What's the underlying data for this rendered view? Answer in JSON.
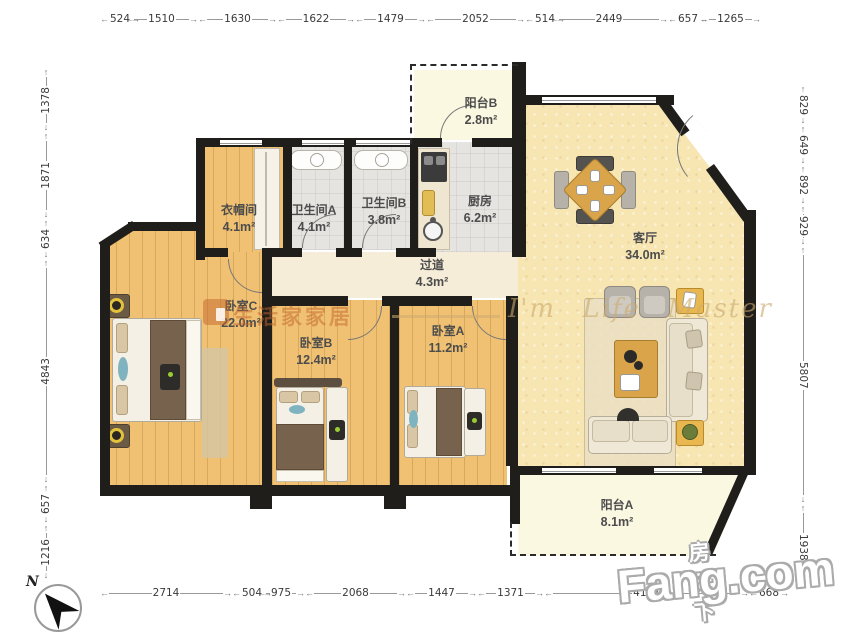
{
  "dims": {
    "top": [
      "524",
      "1510",
      "1630",
      "1622",
      "1479",
      "2052",
      "514",
      "2449",
      "657",
      "1265"
    ],
    "bottom": [
      "2714",
      "504",
      "975",
      "2068",
      "1447",
      "1371",
      "4197",
      "668"
    ],
    "left": [
      "1378",
      "1871",
      "634",
      "4843",
      "657",
      "1216"
    ],
    "right": [
      "829",
      "649",
      "892",
      "929",
      "5807",
      "1938"
    ]
  },
  "rooms": {
    "balcony_b": {
      "name": "阳台B",
      "area": "2.8m²"
    },
    "cloakroom": {
      "name": "衣帽间",
      "area": "4.1m²"
    },
    "bathroom_a": {
      "name": "卫生间A",
      "area": "4.1m²"
    },
    "bathroom_b": {
      "name": "卫生间B",
      "area": "3.8m²"
    },
    "kitchen": {
      "name": "厨房",
      "area": "6.2m²"
    },
    "living_room": {
      "name": "客厅",
      "area": "34.0m²"
    },
    "bedroom_c": {
      "name": "卧室C",
      "area": "22.0m²"
    },
    "corridor": {
      "name": "过道",
      "area": "4.3m²"
    },
    "bedroom_b": {
      "name": "卧室B",
      "area": "12.4m²"
    },
    "bedroom_a": {
      "name": "卧室A",
      "area": "11.2m²"
    },
    "balcony_a": {
      "name": "阳台A",
      "area": "8.1m²"
    }
  },
  "watermarks": {
    "brand_cn": "生活家家居",
    "brand_script": "I'm Life Master",
    "fang_cn": "房天下",
    "fang_en": "Fang.com"
  },
  "compass": {
    "label": "N"
  },
  "colors": {
    "wall": "#201e1b",
    "wood_floor": "#f0c173",
    "tile_floor": "#e6e4e1",
    "living_floor": "#f7e5b2",
    "balcony_floor": "#fbf8e2",
    "accent_wood": "#d9a44a",
    "accent_yellow": "#e9b74f",
    "brand_orange": "rgba(193,102,44,0.5)"
  }
}
